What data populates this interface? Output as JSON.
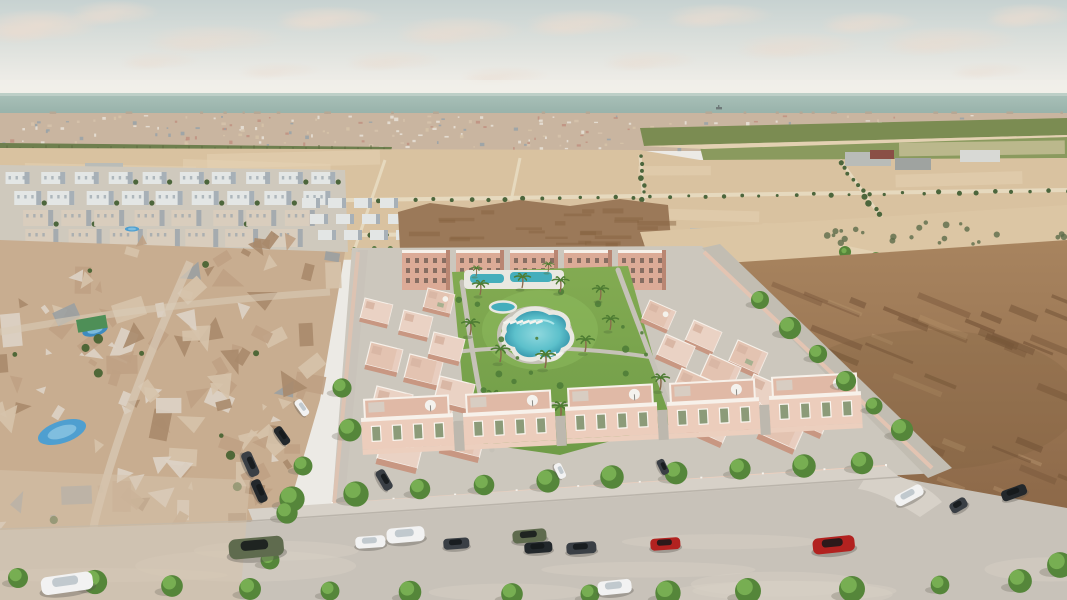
{
  "image": {
    "kind": "aerial-3d-architectural-render",
    "subject": "coastal residential development with central pool park, surrounded by existing neighborhood, vacant lots and sea horizon",
    "width": 1067,
    "height": 600
  },
  "palette": {
    "sky_top": "#c7d2d1",
    "sky_mid": "#dce0dc",
    "sky_low": "#ecebe6",
    "sky_horizon": "#f1efe9",
    "cloud": "#eadcd0",
    "sea_top": "#aac1b9",
    "sea_bottom": "#94afa7",
    "ship": "#6f7a7a",
    "town_base": "#c9b5a0",
    "town_white": "#e8e2d8",
    "town_pink": "#c09180",
    "town_grey": "#98a2a8",
    "town_tan": "#d6c3a8",
    "orchard": "#6e7f4e",
    "orchard_dark": "#5d6c40",
    "field_green": "#7b8c52",
    "field_green2": "#8a9a5e",
    "sand": "#d9c2a0",
    "sand_light": "#e3d1b2",
    "sand_pale": "#dcc6a4",
    "road_distant": "#e8dcc2",
    "tree_distant": "#4c663c",
    "tree_mid": "#5a7a44",
    "estate_white": "#e3e6e5",
    "estate_shadow": "#97a2ab",
    "estate_tan": "#d9cdbd",
    "shed_grey": "#b9bcb8",
    "shed_dark": "#9fa3a0",
    "shed_white": "#d8d9d5",
    "shed_red": "#8a4f46",
    "mound": "#9b7959",
    "mound_dark": "#86613f",
    "dirt_top": "#a8845f",
    "dirt_bottom": "#8c6848",
    "dirt_dark": "#77563a",
    "dirt_light": "#b3906a",
    "mesh_base": "#c8ad90",
    "mesh_tan": "#bfa184",
    "mesh_brown": "#a98a6c",
    "mesh_light": "#d6c3ab",
    "mesh_white": "#ddd3c6",
    "mesh_grey": "#9aa0a2",
    "pool_blue": "#4f9fd0",
    "pool_blue2": "#3e8bbf",
    "tarp_green": "#4e8f57",
    "complex_ground": "#ccc7bd",
    "sidewalk": "#d7d1c8",
    "road_fg": "#c8c2b9",
    "road_wash": "#d6d0c6",
    "wall_pink": "#eccfbe",
    "wall_post": "#f8f4ee",
    "apartment": "#dcab97",
    "apartment_dark": "#b98672",
    "window_dark": "#6b5a50",
    "villa_roof_a": "#ead2c4",
    "villa_roof_b": "#e3c3b1",
    "villa_shadow": "#c89782",
    "villa_trim": "#f7f1ea",
    "front_body": "#eccdbc",
    "front_roof": "#e0b9a6",
    "shutter": "#8c9b79",
    "lawn": "#83ab52",
    "lawn_dark": "#6f9c47",
    "lawn_bright": "#8db95c",
    "path": "#c6c2b8",
    "deck": "#e9e8e1",
    "pool_edge": "#3f9fb2",
    "pool_center": "#8fd8de",
    "pool_strip": "#45aebc",
    "palm_frond": "#4e7c33",
    "trunk": "#8a6a4c",
    "street_tree": "#79b053",
    "street_tree_dark": "#55863a",
    "shrub": "#4f7d38",
    "car_white": "#f2f2f2",
    "car_dark": "#3a3f45",
    "car_dark2": "#23282c",
    "car_olive": "#5f6b4e",
    "car_red": "#b22220",
    "car_grey": "#8e9297"
  },
  "scene": {
    "clouds": [
      [
        40,
        25,
        60,
        16,
        0.9
      ],
      [
        115,
        12,
        45,
        12,
        0.7
      ],
      [
        215,
        38,
        70,
        14,
        0.6
      ],
      [
        330,
        18,
        55,
        12,
        0.8
      ],
      [
        395,
        60,
        50,
        10,
        0.5
      ],
      [
        460,
        30,
        65,
        14,
        0.7
      ],
      [
        505,
        75,
        45,
        9,
        0.45
      ],
      [
        585,
        22,
        60,
        13,
        0.75
      ],
      [
        650,
        60,
        48,
        10,
        0.5
      ],
      [
        720,
        15,
        55,
        12,
        0.7
      ],
      [
        800,
        45,
        65,
        13,
        0.6
      ],
      [
        870,
        22,
        50,
        11,
        0.7
      ],
      [
        950,
        40,
        70,
        14,
        0.65
      ],
      [
        1030,
        15,
        45,
        12,
        0.75
      ],
      [
        990,
        70,
        40,
        8,
        0.4
      ],
      [
        160,
        60,
        40,
        9,
        0.45
      ],
      [
        280,
        70,
        42,
        8,
        0.4
      ]
    ],
    "ship": {
      "x": 716,
      "y": 107
    },
    "apartment_blocks": [
      402,
      456,
      510,
      564,
      618
    ],
    "left_villas": [
      [
        365,
        298
      ],
      [
        371,
        342
      ],
      [
        377,
        386
      ],
      [
        384,
        430
      ],
      [
        404,
        310
      ],
      [
        410,
        354
      ],
      [
        416,
        398
      ],
      [
        428,
        288
      ],
      [
        434,
        332
      ],
      [
        440,
        376
      ],
      [
        447,
        420
      ]
    ],
    "right_block": {
      "x0": 562,
      "y0": 260,
      "ux": 44,
      "uy": 20,
      "rx": 16,
      "ry": 34,
      "rows": 6,
      "units": 7,
      "rot": 24
    },
    "front_villas": [
      [
        360,
        452
      ],
      [
        462,
        447
      ],
      [
        564,
        441
      ],
      [
        666,
        436
      ],
      [
        768,
        430
      ]
    ],
    "palms": [
      [
        480,
        295,
        1
      ],
      [
        522,
        288,
        1
      ],
      [
        560,
        292,
        1.05
      ],
      [
        600,
        300,
        1
      ],
      [
        470,
        335,
        1.1
      ],
      [
        500,
        362,
        1.15
      ],
      [
        545,
        368,
        1.2
      ],
      [
        585,
        352,
        1.1
      ],
      [
        610,
        330,
        1
      ],
      [
        492,
        408,
        1.2
      ],
      [
        560,
        420,
        1.25
      ],
      [
        620,
        408,
        1.2
      ],
      [
        660,
        390,
        1.1
      ],
      [
        476,
        276,
        0.7
      ],
      [
        548,
        272,
        0.7
      ]
    ],
    "loungers_a": {
      "x": 503,
      "y": 322,
      "n": 6,
      "dx": 6.5
    },
    "loungers_b": {
      "x": 536,
      "y": 354,
      "n": 4,
      "dx": 6.5
    },
    "front_trees": [
      [
        292,
        499
      ],
      [
        356,
        494
      ],
      [
        420,
        489
      ],
      [
        484,
        485
      ],
      [
        548,
        481
      ],
      [
        612,
        477
      ],
      [
        676,
        473
      ],
      [
        740,
        469
      ],
      [
        804,
        466
      ],
      [
        862,
        463
      ]
    ],
    "right_street_trees": [
      [
        760,
        300
      ],
      [
        790,
        328
      ],
      [
        818,
        354
      ],
      [
        846,
        381
      ],
      [
        874,
        406
      ],
      [
        902,
        430
      ]
    ],
    "top_road_trees": [
      [
        845,
        252
      ],
      [
        876,
        258
      ],
      [
        907,
        265
      ],
      [
        938,
        272
      ],
      [
        969,
        279
      ],
      [
        1000,
        286
      ],
      [
        1031,
        292
      ],
      [
        1058,
        298
      ]
    ],
    "left_street_trees": [
      [
        303,
        466
      ],
      [
        287,
        513
      ],
      [
        270,
        560
      ],
      [
        350,
        430
      ],
      [
        342,
        388
      ]
    ],
    "bottom_trees": [
      [
        18,
        578
      ],
      [
        95,
        582
      ],
      [
        172,
        586
      ],
      [
        250,
        589
      ],
      [
        330,
        591
      ],
      [
        410,
        592
      ],
      [
        512,
        594
      ],
      [
        590,
        594
      ],
      [
        668,
        593
      ],
      [
        748,
        591
      ],
      [
        852,
        589
      ],
      [
        940,
        585
      ],
      [
        1020,
        581
      ],
      [
        1060,
        565
      ]
    ],
    "pools_existing": [
      {
        "x": 62,
        "y": 432,
        "rx": 25,
        "ry": 11,
        "rot": -18,
        "c": "pool_blue"
      },
      {
        "x": 95,
        "y": 330,
        "rx": 13,
        "ry": 6,
        "rot": -15,
        "c": "pool_blue2"
      },
      {
        "x": 132,
        "y": 229,
        "rx": 7,
        "ry": 2.5,
        "rot": 0,
        "c": "pool_blue"
      }
    ],
    "tarp": {
      "x": 76,
      "y": 320,
      "w": 30,
      "h": 13,
      "rot": -10
    },
    "cars": [
      [
        40,
        578,
        52,
        18,
        -8,
        "car_white"
      ],
      [
        228,
        540,
        55,
        20,
        -5,
        "car_olive"
      ],
      [
        250,
        450,
        26,
        11,
        66,
        "car_dark"
      ],
      [
        259,
        478,
        24,
        10,
        66,
        "car_dark2"
      ],
      [
        355,
        537,
        30,
        12,
        -4,
        "car_white"
      ],
      [
        386,
        529,
        38,
        15,
        -5,
        "car_white"
      ],
      [
        443,
        539,
        26,
        11,
        -4,
        "car_dark"
      ],
      [
        512,
        531,
        34,
        13,
        -5,
        "car_olive"
      ],
      [
        524,
        543,
        28,
        11,
        -4,
        "car_dark2"
      ],
      [
        566,
        543,
        30,
        12,
        -4,
        "car_dark"
      ],
      [
        650,
        539,
        30,
        12,
        -4,
        "car_red"
      ],
      [
        597,
        582,
        34,
        14,
        -6,
        "car_white"
      ],
      [
        812,
        539,
        42,
        16,
        -6,
        "car_red"
      ],
      [
        893,
        497,
        30,
        12,
        -28,
        "car_white"
      ],
      [
        948,
        505,
        18,
        11,
        -30,
        "car_dark"
      ],
      [
        1000,
        492,
        26,
        11,
        -20,
        "car_dark2"
      ],
      [
        383,
        468,
        22,
        10,
        60,
        "car_dark"
      ],
      [
        560,
        462,
        16,
        8,
        64,
        "car_white"
      ],
      [
        663,
        458,
        16,
        8,
        64,
        "car_dark"
      ],
      [
        280,
        425,
        20,
        9,
        55,
        "car_dark2"
      ],
      [
        300,
        398,
        18,
        8,
        55,
        "car_white"
      ]
    ],
    "counts": {
      "town_specks": 280,
      "mesh_shapes": 135,
      "dirt_streaks": 70,
      "sand_patches": 16,
      "shrubs": 26,
      "neigh_trees": 12
    }
  }
}
